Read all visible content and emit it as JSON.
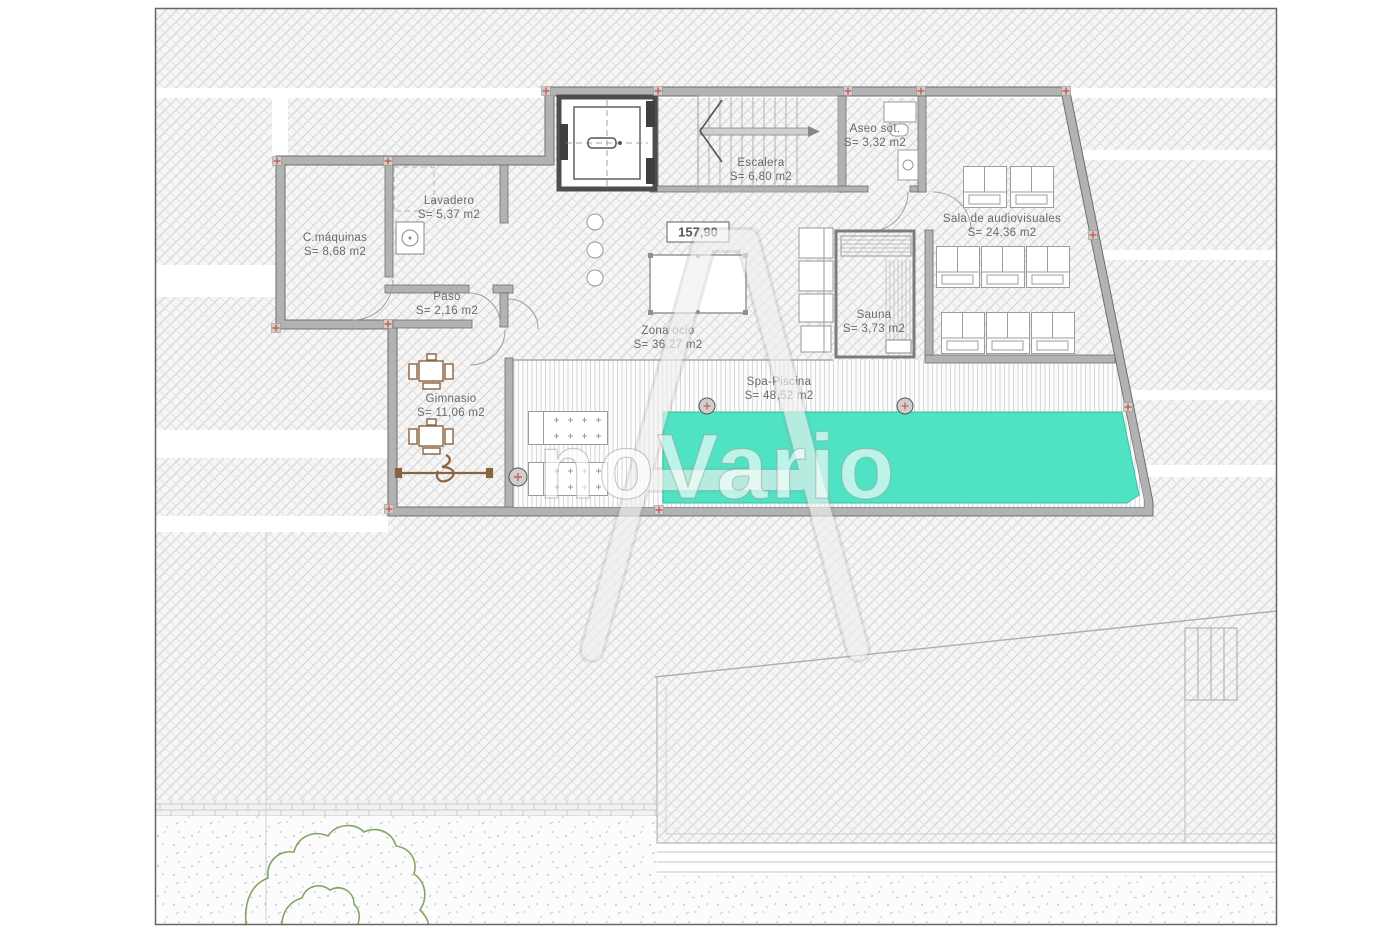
{
  "plan": {
    "title_hint": "basement floor plan",
    "level_marker": "157,90",
    "watermark": "noVario",
    "rooms": [
      {
        "name": "C.máquinas",
        "area": "S= 8,68 m2"
      },
      {
        "name": "Lavadero",
        "area": "S= 5,37 m2"
      },
      {
        "name": "Paso",
        "area": "S= 2,16 m2"
      },
      {
        "name": "Escalera",
        "area": "S= 6,80 m2"
      },
      {
        "name": "Aseo sót.",
        "area": "S= 3,32 m2"
      },
      {
        "name": "Sala de audiovisuales",
        "area": "S= 24,36 m2"
      },
      {
        "name": "Zona ocio",
        "area": "S= 36,27 m2"
      },
      {
        "name": "Sauna",
        "area": "S= 3,73 m2"
      },
      {
        "name": "Spa-Piscina",
        "area": "S= 48,52 m2"
      },
      {
        "name": "Gimnasio",
        "area": "S= 11,06 m2"
      }
    ],
    "colors": {
      "pool": "#4fe3c4",
      "wall": "#b2b2b2",
      "wall_edge": "#6e6e6e",
      "hatch_line": "#d7d7d7",
      "label_text": "#6a6a6a",
      "joint_cross": "#c4625c",
      "tree_outline": "#85a565",
      "gym_equipment": "#8a6340"
    }
  }
}
